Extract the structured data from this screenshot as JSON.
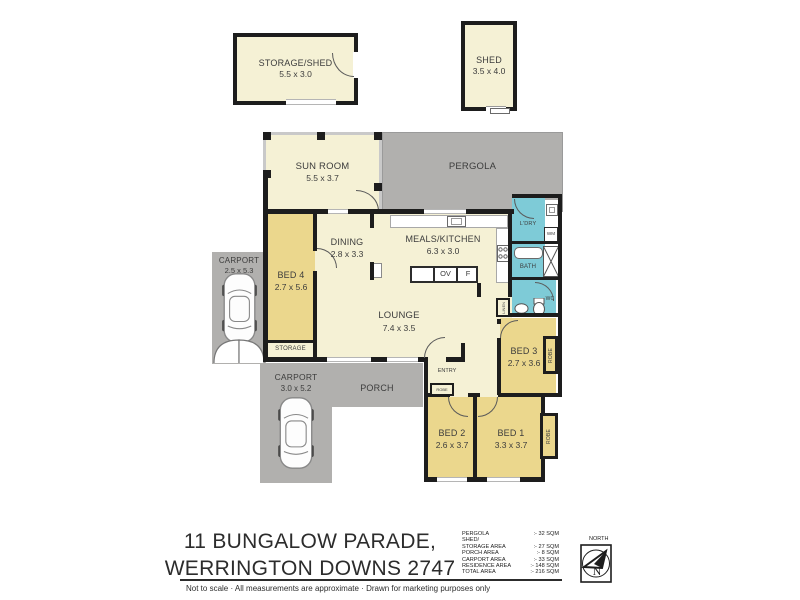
{
  "rooms": {
    "storage_shed": {
      "name": "STORAGE/SHED",
      "dims": "5.5 x 3.0"
    },
    "shed": {
      "name": "SHED",
      "dims": "3.5 x 4.0"
    },
    "sun_room": {
      "name": "SUN ROOM",
      "dims": "5.5 x 3.7"
    },
    "pergola": {
      "name": "PERGOLA"
    },
    "dining": {
      "name": "DINING",
      "dims": "2.8 x 3.3"
    },
    "meals_kitchen": {
      "name": "MEALS/KITCHEN",
      "dims": "6.3 x 3.0"
    },
    "bed4": {
      "name": "BED 4",
      "dims": "2.7 x 5.6"
    },
    "carport_upper": {
      "name": "CARPORT",
      "dims": "2.5 x 5.3"
    },
    "storage_small": {
      "name": "STORAGE"
    },
    "lounge": {
      "name": "LOUNGE",
      "dims": "7.4 x 3.5"
    },
    "laundry": {
      "name": "L'DRY"
    },
    "wm": {
      "name": "WM"
    },
    "bath": {
      "name": "BATH"
    },
    "wc": {
      "name": "WC"
    },
    "linen": {
      "name": "LINEN"
    },
    "entry": {
      "name": "ENTRY"
    },
    "porch": {
      "name": "PORCH"
    },
    "carport_lower": {
      "name": "CARPORT",
      "dims": "3.0 x 5.2"
    },
    "bed3": {
      "name": "BED 3",
      "dims": "2.7 x 3.6"
    },
    "bed2": {
      "name": "BED 2",
      "dims": "2.6 x 3.7"
    },
    "bed1": {
      "name": "BED 1",
      "dims": "3.3 x 3.7"
    },
    "robe": {
      "name": "ROBE"
    },
    "oven": {
      "name": "OV"
    },
    "fridge": {
      "name": "F"
    }
  },
  "footer": {
    "address_line1": "11 BUNGALOW PARADE,",
    "address_line2": "WERRINGTON DOWNS 2747",
    "areas": [
      {
        "label": "PERGOLA",
        "value": ":-  32 SQM"
      },
      {
        "label": "SHED/\nSTORAGE AREA",
        "value": ":-  27 SQM"
      },
      {
        "label": "PORCH AREA",
        "value": ":-  8 SQM"
      },
      {
        "label": "CARPORT AREA",
        "value": ":-  33 SQM"
      },
      {
        "label": "RESIDENCE  AREA",
        "value": ":- 148 SQM"
      },
      {
        "label": "TOTAL  AREA",
        "value": ":- 216 SQM"
      }
    ],
    "north_label": "NORTH",
    "compass_letter": "N",
    "disclaimer": "Not to scale   ·   All measurements are approximate   ·   Drawn for marketing purposes only"
  },
  "colors": {
    "wall": "#1d1d1d",
    "residence_fill": "#f5f1d5",
    "bedroom_fill": "#ebd78d",
    "wet_area_fill": "#7ecbd7",
    "outdoor_fill": "#b1b0ae"
  }
}
